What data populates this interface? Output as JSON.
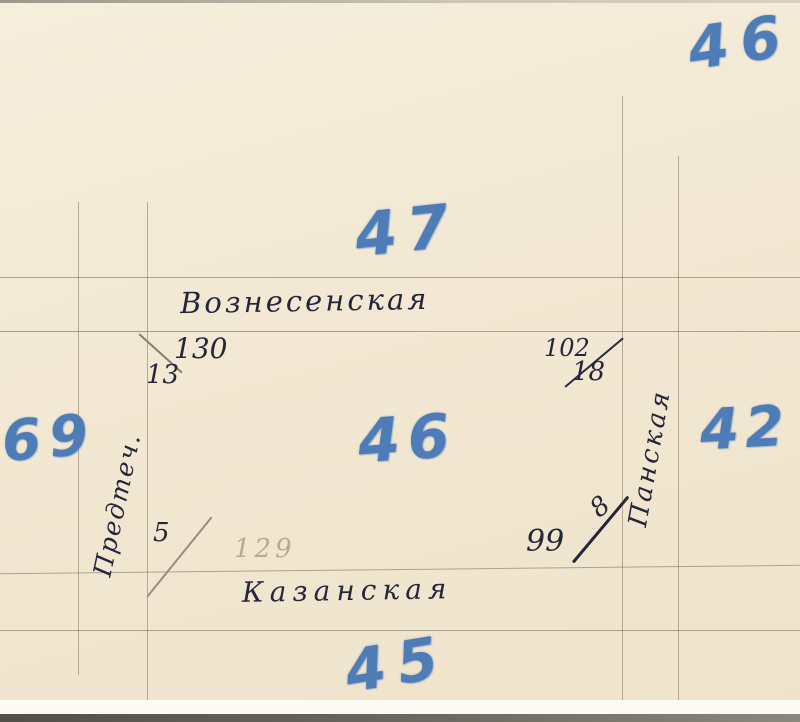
{
  "sketch": {
    "page_number": "46",
    "blocks": {
      "north": "47",
      "center": "46",
      "south": "45",
      "east": "42",
      "west": "69"
    },
    "streets": {
      "north": "Вознесенская",
      "south": "Казанская",
      "west": "Предтеч.",
      "east": "Панская"
    },
    "corner_marks": {
      "northwest": {
        "upper": "130",
        "lower": "13"
      },
      "northeast": {
        "upper": "102",
        "lower": "18"
      },
      "southwest": {
        "ink": "5",
        "pencil": "129"
      },
      "southeast": {
        "main": "99",
        "upper": "8"
      }
    },
    "colors": {
      "paper": "#f2e9d6",
      "marker_blue": "#4d7cb6",
      "ink": "#26263a",
      "pencil_line": "#8d7f6a",
      "pencil_text": "#b7a993"
    }
  }
}
